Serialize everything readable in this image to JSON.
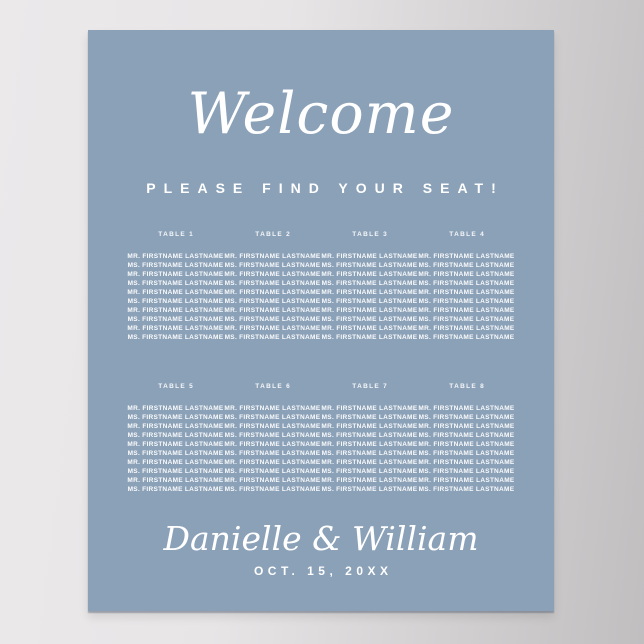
{
  "scene": {
    "wall_color_left": "#ebe9ea",
    "wall_color_right": "#c0bebf"
  },
  "poster": {
    "background_color": "#8ba1b8",
    "text_color": "#ffffff",
    "welcome": "Welcome",
    "subtitle": "PLEASE FIND YOUR SEAT!",
    "couple_names": "Danielle & William",
    "event_date": "OCT. 15, 20XX",
    "tables": [
      {
        "label": "TABLE 1",
        "guests": [
          "MR. FIRSTNAME LASTNAME",
          "MS. FIRSTNAME LASTNAME",
          "MR. FIRSTNAME LASTNAME",
          "MS. FIRSTNAME LASTNAME",
          "MR. FIRSTNAME LASTNAME",
          "MS. FIRSTNAME LASTNAME",
          "MR. FIRSTNAME LASTNAME",
          "MS. FIRSTNAME LASTNAME",
          "MR. FIRSTNAME LASTNAME",
          "MS. FIRSTNAME LASTNAME"
        ]
      },
      {
        "label": "TABLE 2",
        "guests": [
          "MR. FIRSTNAME LASTNAME",
          "MS. FIRSTNAME LASTNAME",
          "MR. FIRSTNAME LASTNAME",
          "MS. FIRSTNAME LASTNAME",
          "MR. FIRSTNAME LASTNAME",
          "MS. FIRSTNAME LASTNAME",
          "MR. FIRSTNAME LASTNAME",
          "MS. FIRSTNAME LASTNAME",
          "MR. FIRSTNAME LASTNAME",
          "MS. FIRSTNAME LASTNAME"
        ]
      },
      {
        "label": "TABLE 3",
        "guests": [
          "MR. FIRSTNAME LASTNAME",
          "MS. FIRSTNAME LASTNAME",
          "MR. FIRSTNAME LASTNAME",
          "MS. FIRSTNAME LASTNAME",
          "MR. FIRSTNAME LASTNAME",
          "MS. FIRSTNAME LASTNAME",
          "MR. FIRSTNAME LASTNAME",
          "MS. FIRSTNAME LASTNAME",
          "MR. FIRSTNAME LASTNAME",
          "MS. FIRSTNAME LASTNAME"
        ]
      },
      {
        "label": "TABLE 4",
        "guests": [
          "MR. FIRSTNAME LASTNAME",
          "MS. FIRSTNAME LASTNAME",
          "MR. FIRSTNAME LASTNAME",
          "MS. FIRSTNAME LASTNAME",
          "MR. FIRSTNAME LASTNAME",
          "MS. FIRSTNAME LASTNAME",
          "MR. FIRSTNAME LASTNAME",
          "MS. FIRSTNAME LASTNAME",
          "MR. FIRSTNAME LASTNAME",
          "MS. FIRSTNAME LASTNAME"
        ]
      },
      {
        "label": "TABLE 5",
        "guests": [
          "MR. FIRSTNAME LASTNAME",
          "MS. FIRSTNAME LASTNAME",
          "MR. FIRSTNAME LASTNAME",
          "MS. FIRSTNAME LASTNAME",
          "MR. FIRSTNAME LASTNAME",
          "MS. FIRSTNAME LASTNAME",
          "MR. FIRSTNAME LASTNAME",
          "MS. FIRSTNAME LASTNAME",
          "MR. FIRSTNAME LASTNAME",
          "MS. FIRSTNAME LASTNAME"
        ]
      },
      {
        "label": "TABLE 6",
        "guests": [
          "MR. FIRSTNAME LASTNAME",
          "MS. FIRSTNAME LASTNAME",
          "MR. FIRSTNAME LASTNAME",
          "MS. FIRSTNAME LASTNAME",
          "MR. FIRSTNAME LASTNAME",
          "MS. FIRSTNAME LASTNAME",
          "MR. FIRSTNAME LASTNAME",
          "MS. FIRSTNAME LASTNAME",
          "MR. FIRSTNAME LASTNAME",
          "MS. FIRSTNAME LASTNAME"
        ]
      },
      {
        "label": "TABLE 7",
        "guests": [
          "MR. FIRSTNAME LASTNAME",
          "MS. FIRSTNAME LASTNAME",
          "MR. FIRSTNAME LASTNAME",
          "MS. FIRSTNAME LASTNAME",
          "MR. FIRSTNAME LASTNAME",
          "MS. FIRSTNAME LASTNAME",
          "MR. FIRSTNAME LASTNAME",
          "MS. FIRSTNAME LASTNAME",
          "MR. FIRSTNAME LASTNAME",
          "MS. FIRSTNAME LASTNAME"
        ]
      },
      {
        "label": "TABLE 8",
        "guests": [
          "MR. FIRSTNAME LASTNAME",
          "MS. FIRSTNAME LASTNAME",
          "MR. FIRSTNAME LASTNAME",
          "MS. FIRSTNAME LASTNAME",
          "MR. FIRSTNAME LASTNAME",
          "MS. FIRSTNAME LASTNAME",
          "MR. FIRSTNAME LASTNAME",
          "MS. FIRSTNAME LASTNAME",
          "MR. FIRSTNAME LASTNAME",
          "MS. FIRSTNAME LASTNAME"
        ]
      }
    ]
  }
}
